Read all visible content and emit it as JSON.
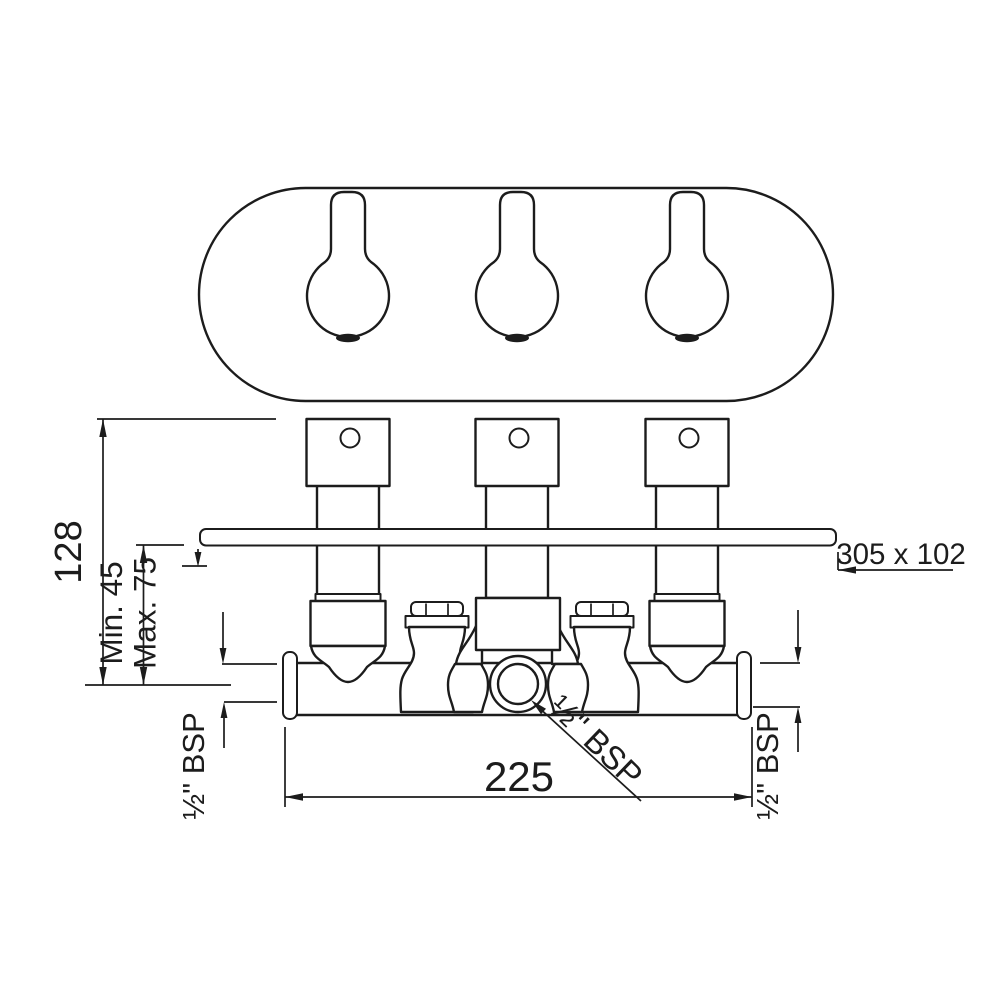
{
  "drawing": {
    "colors": {
      "line": "#1c1c1c",
      "background": "#ffffff"
    },
    "dimensions": {
      "overall_height": "128",
      "depth_min": "Min. 45",
      "depth_max": "Max. 75",
      "faceplate_size": "305 x 102",
      "inlet_centers": "225",
      "outlet_thread": "½\" BSP",
      "inlet_thread_left": "½\" BSP",
      "inlet_thread_right": "½\" BSP"
    }
  }
}
